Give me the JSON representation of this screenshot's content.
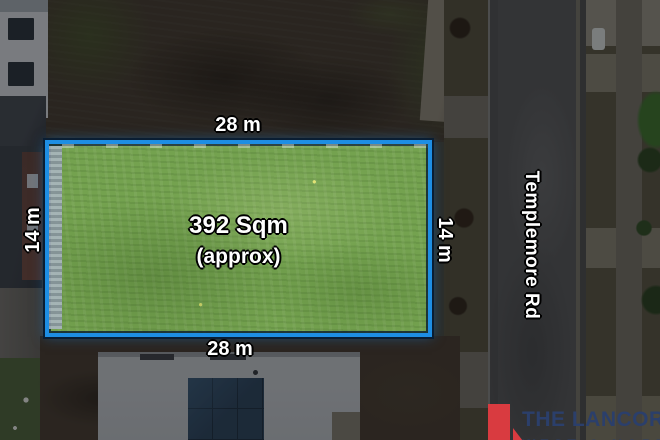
{
  "overlay": {
    "area_label": "392 Sqm",
    "area_note": "(approx)",
    "dimension_top": "28 m",
    "dimension_bottom": "28 m",
    "dimension_left": "14 m",
    "dimension_right": "14 m",
    "road_name": "Templemore Rd"
  },
  "branding": {
    "name": "THE LANCORE",
    "tagline": "WEST & NORTH"
  },
  "colors": {
    "plot_border": "#1e8ee3",
    "plot_grass": "#74a24f",
    "brand_accent": "#d93b40",
    "brand_text": "#2b3f6b",
    "label_text": "#ffffff"
  }
}
